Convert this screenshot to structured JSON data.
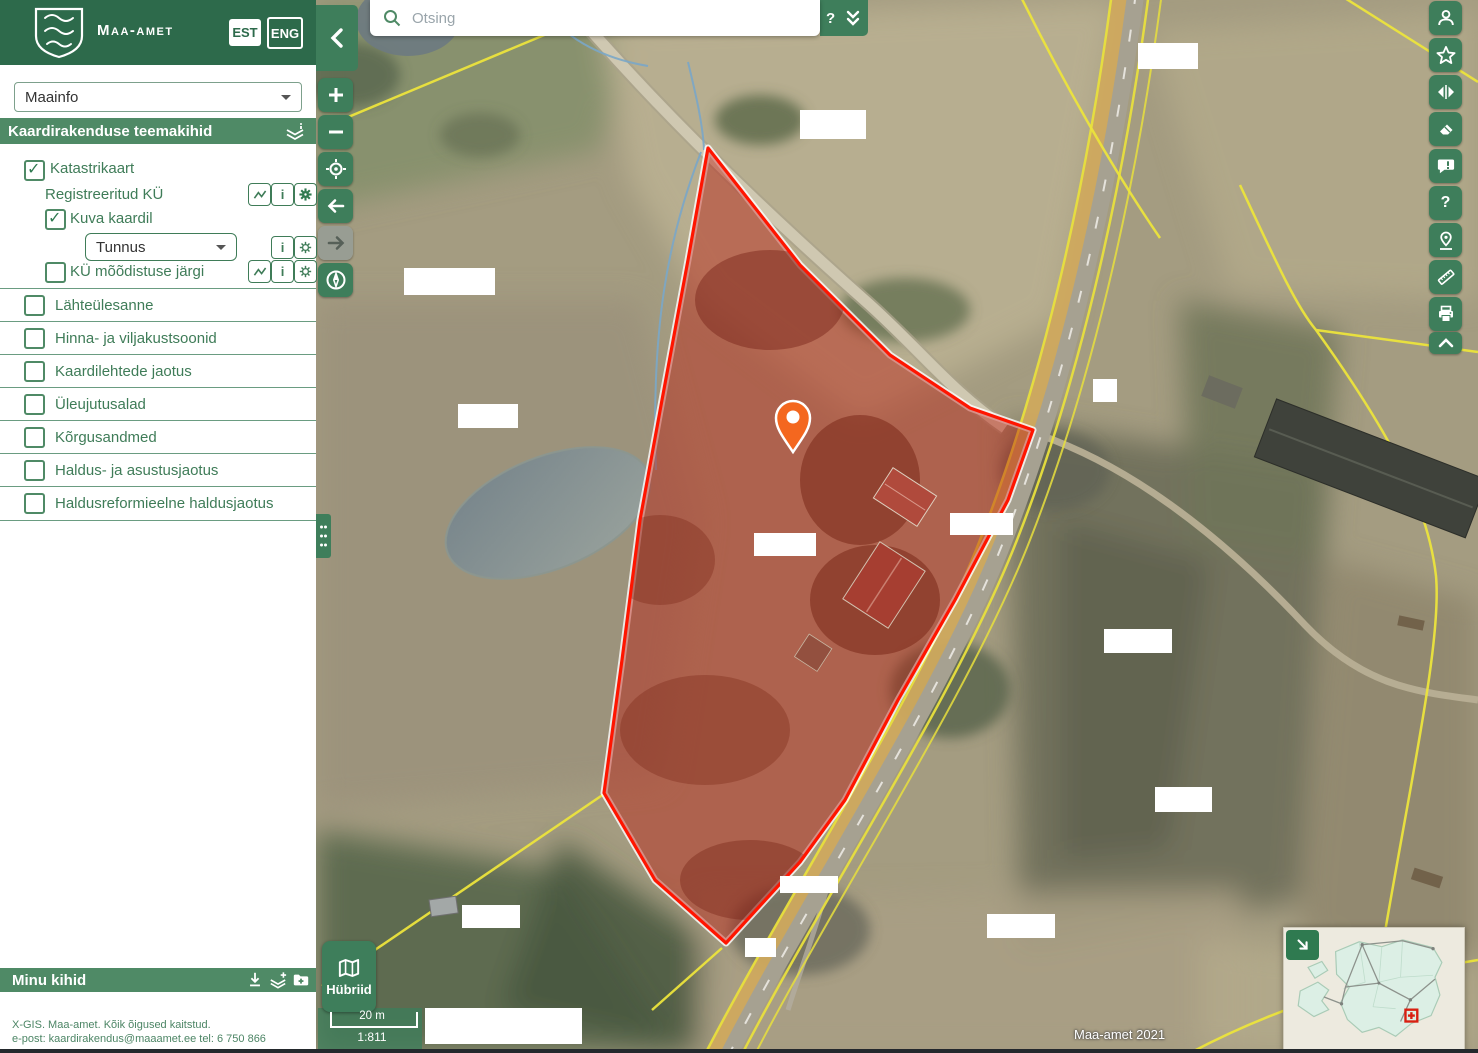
{
  "header": {
    "brand": "Maa-amet",
    "lang_est": "EST",
    "lang_eng": "ENG"
  },
  "sidebar": {
    "app_select": {
      "value": "Maainfo"
    },
    "section_title": "Kaardirakenduse teemakihid",
    "catalog": {
      "katastrikaart": {
        "label": "Katastrikaart",
        "checked": true
      },
      "registreeritud_ku": {
        "label": "Registreeritud KÜ"
      },
      "kuva_kaardil": {
        "label": "Kuva kaardil",
        "checked": true
      },
      "tunnus_select": {
        "value": "Tunnus"
      },
      "ku_moodistuse": {
        "label": "KÜ mõõdistuse järgi",
        "checked": false
      }
    },
    "layers": [
      {
        "label": "Lähteülesanne",
        "checked": false
      },
      {
        "label": "Hinna- ja viljakustsoonid",
        "checked": false
      },
      {
        "label": "Kaardilehtede jaotus",
        "checked": false
      },
      {
        "label": "Üleujutusalad",
        "checked": false
      },
      {
        "label": "Kõrgusandmed",
        "checked": false
      },
      {
        "label": "Haldus- ja asustusjaotus",
        "checked": false
      },
      {
        "label": "Haldusreformieelne haldusjaotus",
        "checked": false
      }
    ],
    "my_layers_title": "Minu kihid",
    "footer_line1": "X-GIS. Maa-amet. Kõik õigused kaitstud.",
    "footer_line2": "e-post: kaardirakendus@maaamet.ee tel: 6 750 866"
  },
  "map": {
    "search_placeholder": "Otsing",
    "help_label": "?",
    "basemap_label": "Hübriid",
    "scale_distance": "20 m",
    "scale_ratio": "1:811",
    "attribution": "Maa-amet 2021"
  },
  "colors": {
    "header_green": "#2d6a4b",
    "bar_green": "#4f8a66",
    "accent": "#3e7e5b",
    "parcel_red": "#ff1500",
    "marker_orange": "#f4671f",
    "cadastral_yellow": "#ece43c"
  }
}
